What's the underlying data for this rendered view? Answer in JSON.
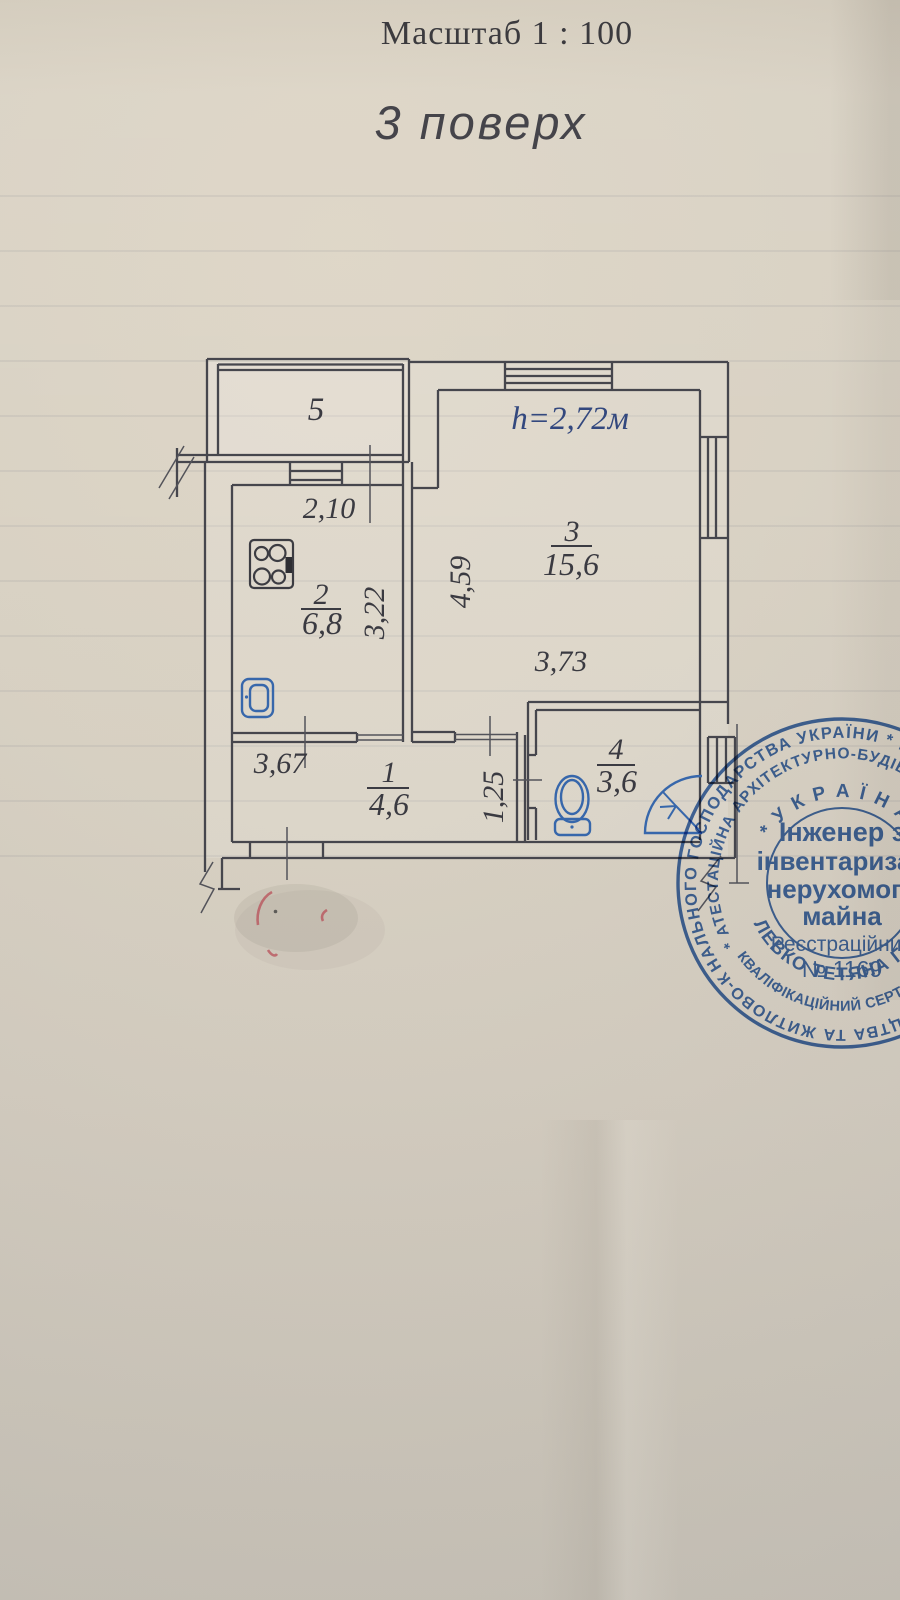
{
  "header": {
    "scale_label": "Масштаб  1 : 100",
    "floor_label": "3  поверх"
  },
  "plan": {
    "ceiling_height_note": "h=2,72м",
    "rooms": [
      {
        "number": "5"
      },
      {
        "number": "2",
        "area": "6,8"
      },
      {
        "number": "3",
        "area": "15,6"
      },
      {
        "number": "1",
        "area": "4,6"
      },
      {
        "number": "4",
        "area": "3,6"
      }
    ],
    "dimensions": {
      "balcony_door_width": "2,10",
      "kitchen_width": "3,22",
      "living_depth": "4,59",
      "living_width": "3,73",
      "hall_width": "3,67",
      "corridor_width": "1,25"
    },
    "fixture_icons": [
      "stove-icon",
      "sink-icon",
      "toilet-icon",
      "shower-icon"
    ]
  },
  "stamp": {
    "outer_ring_top": "НАЛЬНОГО ГОСПОДАРСТВА УКРАЇНИ * МІНІСТЕРСТВ",
    "outer_ring_bottom": "БУДІВНИЦТВА ТА ЖИТЛОВО-КОМУ",
    "middle_ring_top": "* АТЕСТАЦІЙНА  АРХІТЕКТУРНО-БУДІВ",
    "middle_ring_bottom": "КВАЛІФІКАЦІЙНИЙ СЕРТИФІКА",
    "country": "* У К Р А Ї Н А *",
    "title_line1": "Інженер з",
    "title_line2": "інвентаризац",
    "title_line3": "нерухомого",
    "title_line4": "майна",
    "registration_label": "Реєстраційний",
    "registration_number": "№ 1169",
    "name": "ЛЕВКО ТЕТЯНА ГРИГ"
  },
  "colors": {
    "plan_line": "#46464d",
    "ink": "#3a3a41",
    "fixture_blue": "#3767ab",
    "height_note_blue": "#33487e",
    "stamp_blue": "#2e5fae",
    "red_pencil": "#b84f58"
  }
}
